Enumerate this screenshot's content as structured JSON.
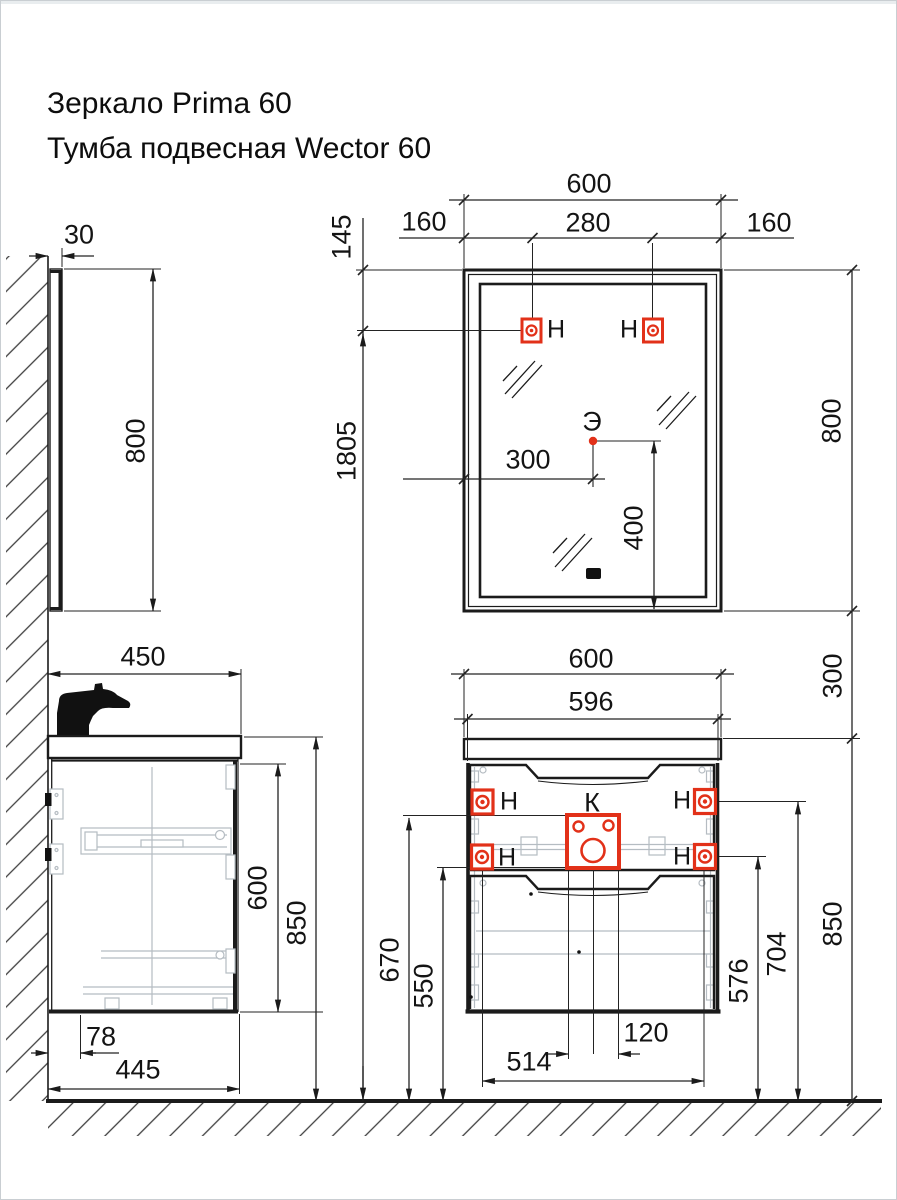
{
  "title": {
    "line1": "Зеркало Prima 60",
    "line2": "Тумба подвесная Wector 60"
  },
  "labels": {
    "hook": "Н",
    "drain_bracket": "К",
    "electrical": "Э"
  },
  "mirror_front": {
    "width": "600",
    "hook_offset_left": "160",
    "hook_spacing": "280",
    "hook_offset_right": "160",
    "top_to_hooks": "145",
    "height": "800",
    "hooks_height_from_floor": "1805",
    "electrical_from_left": "300",
    "electrical_from_bottom": "400"
  },
  "mirror_side": {
    "thickness": "30",
    "height": "800"
  },
  "gap_mirror_to_cabinet": "300",
  "cabinet_front": {
    "width": "600",
    "body_width": "596",
    "height_from_floor": "850",
    "upper_hooks_from_floor": "704",
    "lower_hooks_from_floor": "576",
    "drain_top_from_floor": "670",
    "drain_bottom_from_floor": "550",
    "lower_hooks_spacing": "514",
    "drain_bracket_width": "120"
  },
  "cabinet_side": {
    "depth": "450",
    "body_height": "600",
    "height_from_floor": "850",
    "back_offset": "78",
    "bottom_depth": "445"
  },
  "colors": {
    "accent_red": "#e23119",
    "line": "#1b1b1b",
    "hardware_gray": "#b5bcc2"
  }
}
